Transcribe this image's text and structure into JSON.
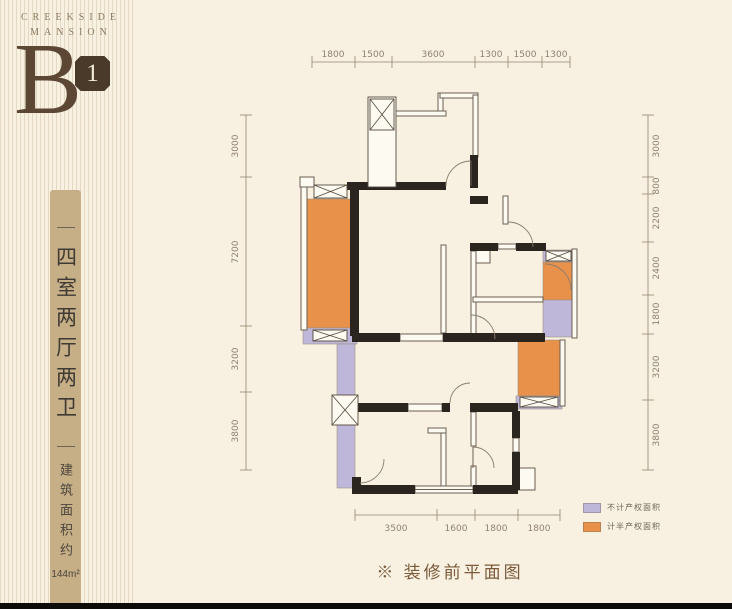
{
  "brand": {
    "line1": "CREEKSIDE",
    "line2": "MANSION",
    "unit_letter": "B",
    "unit_number": "1"
  },
  "unit_info": {
    "layout_title": "四室两厅两卫",
    "area_label": "建筑面积约",
    "area_value": "144m²"
  },
  "caption": "※ 装修前平面图",
  "legend": [
    {
      "label": "不计产权面积",
      "color": "#bfb7da"
    },
    {
      "label": "计半产权面积",
      "color": "#e8914b"
    }
  ],
  "plan": {
    "dims_top": [
      "1800",
      "1500",
      "3600",
      "1300",
      "1500",
      "1300"
    ],
    "dims_left": [
      "3000",
      "7200",
      "3200",
      "3800"
    ],
    "dims_right": [
      "3000",
      "800",
      "2200",
      "2400",
      "1800",
      "3200",
      "3800"
    ],
    "dims_bottom": [
      "3500",
      "1600",
      "1800",
      "1800"
    ]
  },
  "colors": {
    "background": "#f8f1e2",
    "brand_brown": "#8d7c63",
    "dark_brown": "#5c4734",
    "column_tan": "#c6ae87",
    "caption_brown": "#7a5a3a",
    "wall_black": "#2b2520",
    "dim_line": "#93846f",
    "orange": "#e8914b",
    "lavender": "#bfb7da"
  }
}
